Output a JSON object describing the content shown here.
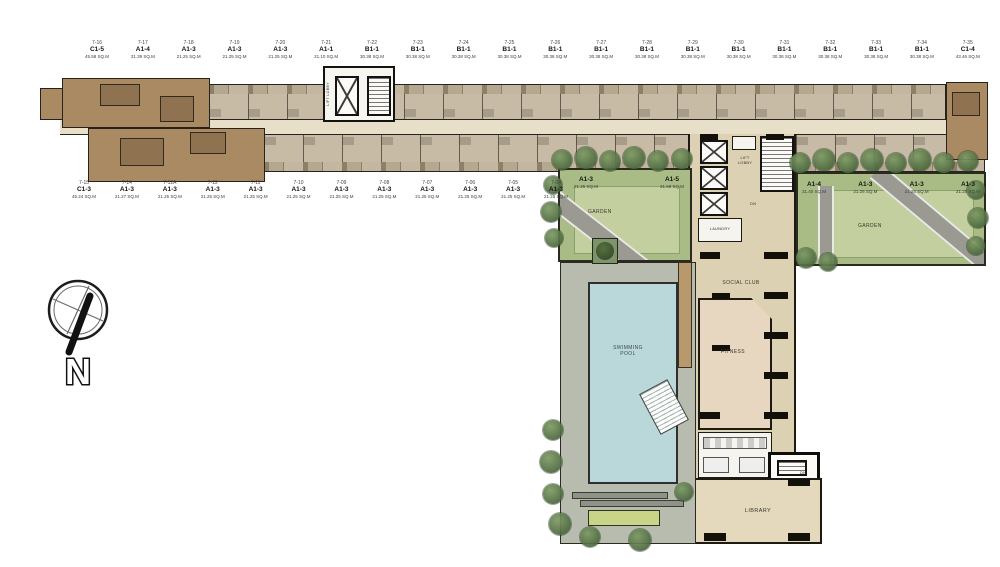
{
  "plan": {
    "compass_label": "N",
    "amenities": {
      "garden_left": "GARDEN",
      "garden_right": "GARDEN",
      "swimming_pool_line1": "SWIMMING",
      "swimming_pool_line2": "POOL",
      "social_club": "SOCIAL CLUB",
      "fitness": "FITNESS",
      "library": "LIBRARY",
      "laundry": "LAUNDRY",
      "lift_lobby_main_line1": "LIFT",
      "lift_lobby_main_line2": "LOBBY",
      "lift_lobby_wing": "LIFT LOBBY",
      "dn_upper": "DN",
      "dn_lower": "DN"
    },
    "top_units": [
      {
        "no": "7-16",
        "type": "C1-5",
        "area": "45.58 SQ.M"
      },
      {
        "no": "7-17",
        "type": "A1-4",
        "area": "31.39 SQ.M"
      },
      {
        "no": "7-18",
        "type": "A1-3",
        "area": "21.25 SQ.M"
      },
      {
        "no": "7-19",
        "type": "A1-3",
        "area": "21.25 SQ.M"
      },
      {
        "no": "7-20",
        "type": "A1-3",
        "area": "21.25 SQ.M"
      },
      {
        "no": "7-21",
        "type": "A1-1",
        "area": "21.10 SQ.M"
      },
      {
        "no": "7-22",
        "type": "B1-1",
        "area": "30.38 SQ.M"
      },
      {
        "no": "7-23",
        "type": "B1-1",
        "area": "30.38 SQ.M"
      },
      {
        "no": "7-24",
        "type": "B1-1",
        "area": "30.38 SQ.M"
      },
      {
        "no": "7-25",
        "type": "B1-1",
        "area": "30.38 SQ.M"
      },
      {
        "no": "7-26",
        "type": "B1-1",
        "area": "30.38 SQ.M"
      },
      {
        "no": "7-27",
        "type": "B1-1",
        "area": "30.38 SQ.M"
      },
      {
        "no": "7-28",
        "type": "B1-1",
        "area": "30.38 SQ.M"
      },
      {
        "no": "7-29",
        "type": "B1-1",
        "area": "30.38 SQ.M"
      },
      {
        "no": "7-30",
        "type": "B1-1",
        "area": "30.38 SQ.M"
      },
      {
        "no": "7-31",
        "type": "B1-1",
        "area": "30.38 SQ.M"
      },
      {
        "no": "7-32",
        "type": "B1-1",
        "area": "30.38 SQ.M"
      },
      {
        "no": "7-33",
        "type": "B1-1",
        "area": "30.38 SQ.M"
      },
      {
        "no": "7-34",
        "type": "B1-1",
        "area": "30.38 SQ.M"
      },
      {
        "no": "7-35",
        "type": "C1-4",
        "area": "43.46 SQ.M"
      }
    ],
    "bottom_units": [
      {
        "no": "7-15",
        "type": "C1-3",
        "area": "45.24 SQ.M"
      },
      {
        "no": "7-14",
        "type": "A1-3",
        "area": "21.27 SQ.M"
      },
      {
        "no": "7-12A",
        "type": "A1-3",
        "area": "21.25 SQ.M"
      },
      {
        "no": "7-12",
        "type": "A1-3",
        "area": "21.25 SQ.M"
      },
      {
        "no": "7-11",
        "type": "A1-3",
        "area": "21.25 SQ.M"
      },
      {
        "no": "7-10",
        "type": "A1-3",
        "area": "21.25 SQ.M"
      },
      {
        "no": "7-09",
        "type": "A1-3",
        "area": "21.25 SQ.M"
      },
      {
        "no": "7-08",
        "type": "A1-3",
        "area": "21.25 SQ.M"
      },
      {
        "no": "7-07",
        "type": "A1-3",
        "area": "21.25 SQ.M"
      },
      {
        "no": "7-06",
        "type": "A1-3",
        "area": "21.25 SQ.M"
      },
      {
        "no": "7-05",
        "type": "A1-3",
        "area": "21.25 SQ.M"
      },
      {
        "no": "7-04",
        "type": "A1-3",
        "area": "21.25 SQ.M"
      }
    ],
    "left_garden_units": [
      {
        "type": "A1-3",
        "area": "21.25 SQ.M"
      },
      {
        "type": "A1-5",
        "area": "31.58 SQ.M"
      }
    ],
    "right_garden_units": [
      {
        "type": "A1-4",
        "area": "31.40 SQ.M"
      },
      {
        "type": "A1-3",
        "area": "21.25 SQ.M"
      },
      {
        "type": "A1-3",
        "area": "21.25 SQ.M"
      },
      {
        "type": "A1-3",
        "area": "21.25 SQ.M"
      }
    ],
    "colors": {
      "unit_fill": "#c7bba6",
      "corner_unit_fill": "#aa8a62",
      "corridor": "#e8dfc8",
      "garden_green": "#a9bc85",
      "pool_blue": "#bad7d9",
      "amenity_floor": "#ddd1b4",
      "tree_green": "#4d6a40"
    }
  }
}
